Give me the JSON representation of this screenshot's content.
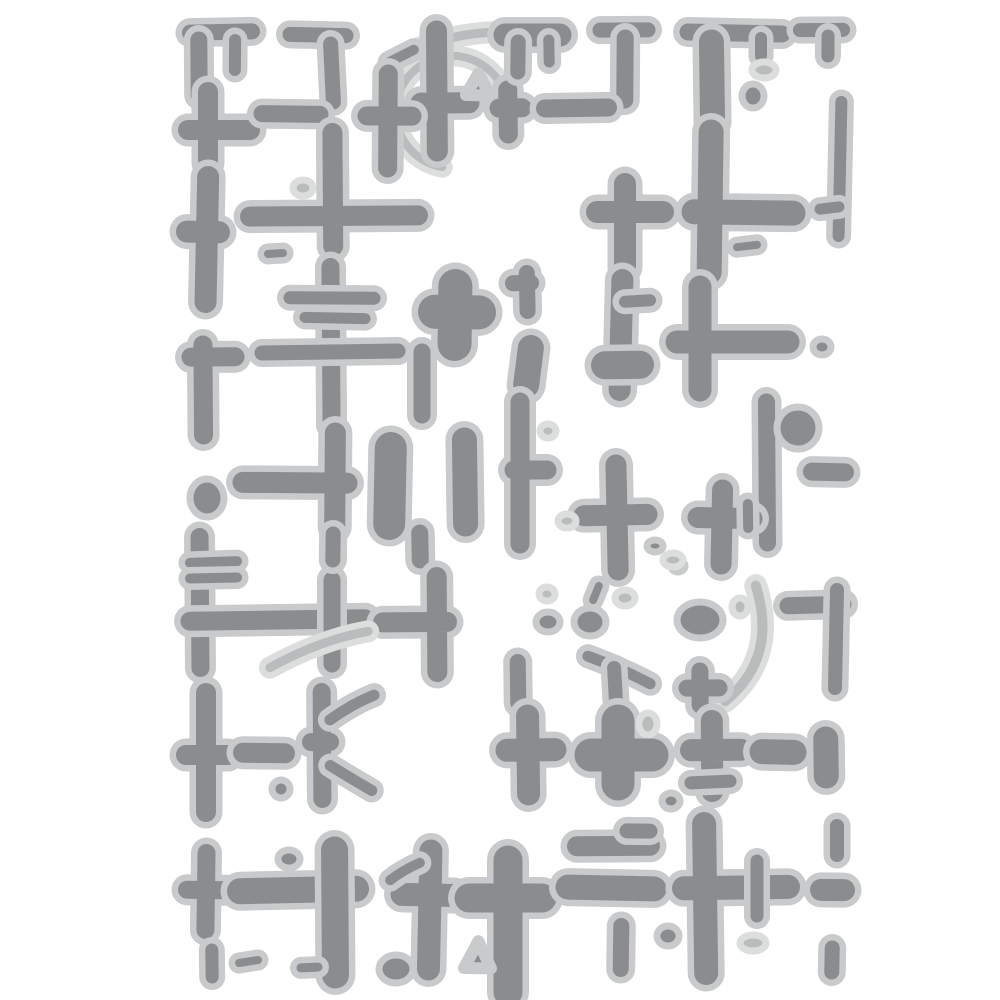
{
  "artwork": {
    "alt": "Abstract distressed pattern of grey crosses, bars, dots, arcs and a crosshair circle on a white background (embossing stencil style)",
    "pattern_name": "distressed-crosses-grid"
  },
  "canvas": {
    "width": 1000,
    "height": 1000,
    "background": "#ffffff"
  },
  "palette": {
    "shape_fill": "#8a8c8e",
    "halo": "#c8cacb",
    "light_fill": "#b9bbbd",
    "light_halo": "#dcdedd",
    "halo_extra_width": 13
  },
  "shapes": [
    {
      "type": "bar",
      "x1": 190,
      "y1": 32,
      "x2": 252,
      "y2": 32,
      "w": 16
    },
    {
      "type": "bar",
      "x1": 199,
      "y1": 40,
      "x2": 199,
      "y2": 95,
      "w": 17
    },
    {
      "type": "bar",
      "x1": 235,
      "y1": 40,
      "x2": 235,
      "y2": 70,
      "w": 12
    },
    {
      "type": "bar",
      "x1": 290,
      "y1": 35,
      "x2": 346,
      "y2": 35,
      "w": 15
    },
    {
      "type": "bar",
      "x1": 331,
      "y1": 44,
      "x2": 333,
      "y2": 102,
      "w": 15
    },
    {
      "type": "arc",
      "x": 452,
      "y": 112,
      "r": 56,
      "a1": 100,
      "a2": 350,
      "w": 8,
      "shade": "light"
    },
    {
      "type": "curve",
      "x1": 400,
      "y1": 57,
      "cx": 458,
      "cy": 28,
      "x2": 517,
      "y2": 32,
      "w": 9,
      "shade": "light"
    },
    {
      "type": "bar",
      "x1": 389,
      "y1": 62,
      "x2": 414,
      "y2": 50,
      "w": 10
    },
    {
      "type": "cross",
      "x": 437,
      "y": 103,
      "up": 72,
      "down": 48,
      "left": 16,
      "right": 32,
      "w": 21
    },
    {
      "type": "cross",
      "x": 388,
      "y": 116,
      "up": 42,
      "down": 52,
      "left": 21,
      "right": 24,
      "w": 19
    },
    {
      "type": "tri",
      "points": [
        [
          466,
          95
        ],
        [
          490,
          95
        ],
        [
          478,
          73
        ]
      ]
    },
    {
      "type": "cross",
      "x": 508,
      "y": 108,
      "up": 18,
      "down": 26,
      "left": 9,
      "right": 14,
      "w": 19
    },
    {
      "type": "bar",
      "x1": 505,
      "y1": 35,
      "x2": 560,
      "y2": 35,
      "w": 23
    },
    {
      "type": "bar",
      "x1": 518,
      "y1": 42,
      "x2": 518,
      "y2": 72,
      "w": 15
    },
    {
      "type": "bar",
      "x1": 549,
      "y1": 40,
      "x2": 549,
      "y2": 62,
      "w": 11
    },
    {
      "type": "bar",
      "x1": 600,
      "y1": 30,
      "x2": 648,
      "y2": 30,
      "w": 15
    },
    {
      "type": "bar",
      "x1": 625,
      "y1": 38,
      "x2": 625,
      "y2": 100,
      "w": 17
    },
    {
      "type": "bar",
      "x1": 688,
      "y1": 33,
      "x2": 782,
      "y2": 33,
      "w": 17
    },
    {
      "type": "bar",
      "x1": 712,
      "y1": 42,
      "x2": 712,
      "y2": 122,
      "w": 25
    },
    {
      "type": "bar",
      "x1": 761,
      "y1": 38,
      "x2": 761,
      "y2": 56,
      "w": 12
    },
    {
      "type": "dot",
      "x": 764,
      "y": 70,
      "rx": 12,
      "ry": 8,
      "shade": "light"
    },
    {
      "type": "dot",
      "x": 753,
      "y": 96,
      "rx": 11,
      "ry": 12
    },
    {
      "type": "bar",
      "x1": 800,
      "y1": 30,
      "x2": 843,
      "y2": 30,
      "w": 14
    },
    {
      "type": "bar",
      "x1": 828,
      "y1": 36,
      "x2": 828,
      "y2": 56,
      "w": 13
    },
    {
      "type": "bar",
      "x1": 840,
      "y1": 102,
      "x2": 840,
      "y2": 236,
      "w": 12
    },
    {
      "type": "bar",
      "x1": 820,
      "y1": 209,
      "x2": 839,
      "y2": 207,
      "w": 11
    },
    {
      "type": "cross",
      "x": 208,
      "y": 130,
      "up": 38,
      "down": 33,
      "left": 20,
      "right": 42,
      "w": 20
    },
    {
      "type": "bar",
      "x1": 262,
      "y1": 114,
      "x2": 320,
      "y2": 114,
      "w": 17
    },
    {
      "type": "dot",
      "x": 303,
      "y": 188,
      "rx": 10,
      "ry": 8,
      "shade": "light"
    },
    {
      "type": "cross",
      "x": 333,
      "y": 216,
      "up": 83,
      "down": 30,
      "left": 83,
      "right": 85,
      "w": 20
    },
    {
      "type": "bar",
      "x1": 268,
      "y1": 254,
      "x2": 283,
      "y2": 253,
      "w": 8
    },
    {
      "type": "cross",
      "x": 207,
      "y": 232,
      "up": 55,
      "down": 70,
      "left": 20,
      "right": 12,
      "w": 22
    },
    {
      "type": "bar",
      "x1": 545,
      "y1": 108,
      "x2": 608,
      "y2": 108,
      "w": 18
    },
    {
      "type": "cross",
      "x": 625,
      "y": 212,
      "up": 28,
      "down": 55,
      "left": 28,
      "right": 38,
      "w": 22
    },
    {
      "type": "cross",
      "x": 710,
      "y": 212,
      "up": 80,
      "down": 60,
      "left": 16,
      "right": 83,
      "w": 25
    },
    {
      "type": "bar",
      "x1": 737,
      "y1": 247,
      "x2": 757,
      "y2": 245,
      "w": 8
    },
    {
      "type": "bar",
      "x1": 331,
      "y1": 267,
      "x2": 331,
      "y2": 425,
      "w": 18
    },
    {
      "type": "bar",
      "x1": 290,
      "y1": 298,
      "x2": 374,
      "y2": 298,
      "w": 13
    },
    {
      "type": "bar",
      "x1": 305,
      "y1": 318,
      "x2": 365,
      "y2": 318,
      "w": 11
    },
    {
      "type": "bar",
      "x1": 262,
      "y1": 352,
      "x2": 398,
      "y2": 352,
      "w": 15
    },
    {
      "type": "bar",
      "x1": 422,
      "y1": 352,
      "x2": 422,
      "y2": 415,
      "w": 17
    },
    {
      "type": "cross",
      "x": 455,
      "y": 312,
      "up": 26,
      "down": 32,
      "left": 20,
      "right": 24,
      "w": 34
    },
    {
      "type": "cross",
      "x": 527,
      "y": 283,
      "up": 10,
      "down": 28,
      "left": 14,
      "right": 4,
      "w": 16
    },
    {
      "type": "bar",
      "x1": 531,
      "y1": 348,
      "x2": 526,
      "y2": 385,
      "w": 26
    },
    {
      "type": "bar",
      "x1": 622,
      "y1": 280,
      "x2": 620,
      "y2": 390,
      "w": 22
    },
    {
      "type": "bar",
      "x1": 625,
      "y1": 302,
      "x2": 650,
      "y2": 300,
      "w": 12
    },
    {
      "type": "bar",
      "x1": 605,
      "y1": 365,
      "x2": 640,
      "y2": 365,
      "w": 28
    },
    {
      "type": "cross",
      "x": 700,
      "y": 342,
      "up": 55,
      "down": 48,
      "left": 23,
      "right": 88,
      "w": 23
    },
    {
      "type": "dot",
      "x": 822,
      "y": 347,
      "rx": 9,
      "ry": 8
    },
    {
      "type": "dot",
      "x": 207,
      "y": 498,
      "rx": 17,
      "ry": 19
    },
    {
      "type": "cross",
      "x": 203,
      "y": 357,
      "up": 12,
      "down": 78,
      "left": 12,
      "right": 32,
      "w": 19
    },
    {
      "type": "cross",
      "x": 335,
      "y": 483,
      "up": 50,
      "down": 44,
      "left": 92,
      "right": 12,
      "w": 21
    },
    {
      "type": "bar",
      "x1": 390,
      "y1": 448,
      "x2": 390,
      "y2": 524,
      "w": 32
    },
    {
      "type": "bar",
      "x1": 465,
      "y1": 440,
      "x2": 465,
      "y2": 524,
      "w": 25
    },
    {
      "type": "cross",
      "x": 520,
      "y": 470,
      "up": 68,
      "down": 74,
      "left": 6,
      "right": 27,
      "w": 19
    },
    {
      "type": "dot",
      "x": 548,
      "y": 431,
      "rx": 8,
      "ry": 7,
      "shade": "light"
    },
    {
      "type": "cross",
      "x": 617,
      "y": 515,
      "up": 50,
      "down": 55,
      "left": 33,
      "right": 30,
      "w": 21
    },
    {
      "type": "bar",
      "x1": 767,
      "y1": 402,
      "x2": 767,
      "y2": 543,
      "w": 17
    },
    {
      "type": "dot",
      "x": 798,
      "y": 428,
      "rx": 21,
      "ry": 21
    },
    {
      "type": "bar",
      "x1": 812,
      "y1": 472,
      "x2": 845,
      "y2": 472,
      "w": 18
    },
    {
      "type": "dot",
      "x": 567,
      "y": 521,
      "rx": 9,
      "ry": 7,
      "shade": "light"
    },
    {
      "type": "dot",
      "x": 655,
      "y": 546,
      "rx": 8,
      "ry": 6
    },
    {
      "type": "dot",
      "x": 678,
      "y": 566,
      "rx": 7,
      "ry": 6
    },
    {
      "type": "dot",
      "x": 625,
      "y": 598,
      "rx": 10,
      "ry": 8,
      "shade": "light"
    },
    {
      "type": "bar",
      "x1": 200,
      "y1": 537,
      "x2": 200,
      "y2": 668,
      "w": 18
    },
    {
      "type": "bar",
      "x1": 190,
      "y1": 563,
      "x2": 237,
      "y2": 561,
      "w": 10
    },
    {
      "type": "bar",
      "x1": 190,
      "y1": 579,
      "x2": 237,
      "y2": 577,
      "w": 10
    },
    {
      "type": "bar",
      "x1": 190,
      "y1": 620,
      "x2": 365,
      "y2": 620,
      "w": 19
    },
    {
      "type": "bar",
      "x1": 332,
      "y1": 580,
      "x2": 332,
      "y2": 664,
      "w": 17
    },
    {
      "type": "bar",
      "x1": 333,
      "y1": 534,
      "x2": 333,
      "y2": 560,
      "w": 15
    },
    {
      "type": "bar",
      "x1": 420,
      "y1": 533,
      "x2": 420,
      "y2": 560,
      "w": 17
    },
    {
      "type": "cross",
      "x": 437,
      "y": 622,
      "up": 45,
      "down": 50,
      "left": 54,
      "right": 10,
      "w": 20
    },
    {
      "type": "curve",
      "x1": 270,
      "y1": 668,
      "cx": 320,
      "cy": 640,
      "x2": 368,
      "y2": 631,
      "w": 9,
      "shade": "light"
    },
    {
      "type": "cross",
      "x": 722,
      "y": 518,
      "up": 28,
      "down": 46,
      "left": 24,
      "right": 30,
      "w": 21
    },
    {
      "type": "bar",
      "x1": 748,
      "y1": 504,
      "x2": 748,
      "y2": 528,
      "w": 10
    },
    {
      "type": "dot",
      "x": 700,
      "y": 620,
      "rx": 23,
      "ry": 18
    },
    {
      "type": "dot",
      "x": 740,
      "y": 607,
      "rx": 8,
      "ry": 9,
      "shade": "light"
    },
    {
      "type": "curve",
      "x1": 757,
      "y1": 586,
      "cx": 778,
      "cy": 658,
      "x2": 724,
      "y2": 701,
      "w": 10,
      "shade": "light"
    },
    {
      "type": "cross",
      "x": 700,
      "y": 688,
      "up": 17,
      "down": 17,
      "left": 13,
      "right": 19,
      "w": 17
    },
    {
      "type": "bar",
      "x1": 788,
      "y1": 606,
      "x2": 843,
      "y2": 604,
      "w": 17
    },
    {
      "type": "bar",
      "x1": 836,
      "y1": 590,
      "x2": 836,
      "y2": 688,
      "w": 14
    },
    {
      "type": "dot",
      "x": 673,
      "y": 560,
      "rx": 10,
      "ry": 7,
      "shade": "light"
    },
    {
      "type": "dot",
      "x": 548,
      "y": 622,
      "rx": 12,
      "ry": 10
    },
    {
      "type": "dot",
      "x": 590,
      "y": 622,
      "rx": 16,
      "ry": 14
    },
    {
      "type": "bar",
      "x1": 593,
      "y1": 600,
      "x2": 599,
      "y2": 586,
      "w": 8
    },
    {
      "type": "curve",
      "x1": 588,
      "y1": 656,
      "cx": 620,
      "cy": 668,
      "x2": 650,
      "y2": 684,
      "w": 11
    },
    {
      "type": "bar",
      "x1": 614,
      "y1": 668,
      "x2": 616,
      "y2": 700,
      "w": 14
    },
    {
      "type": "dot",
      "x": 547,
      "y": 594,
      "rx": 8,
      "ry": 7,
      "shade": "light"
    },
    {
      "type": "bar",
      "x1": 518,
      "y1": 662,
      "x2": 518,
      "y2": 703,
      "w": 16
    },
    {
      "type": "cross",
      "x": 206,
      "y": 755,
      "up": 62,
      "down": 57,
      "left": 20,
      "right": 22,
      "w": 20
    },
    {
      "type": "bar",
      "x1": 243,
      "y1": 753,
      "x2": 285,
      "y2": 753,
      "w": 20
    },
    {
      "type": "dot",
      "x": 281,
      "y": 789,
      "rx": 9,
      "ry": 9
    },
    {
      "type": "cross",
      "x": 322,
      "y": 742,
      "up": 50,
      "down": 57,
      "left": 11,
      "right": 8,
      "w": 18
    },
    {
      "type": "curve",
      "x1": 330,
      "y1": 720,
      "cx": 352,
      "cy": 704,
      "x2": 374,
      "y2": 695,
      "w": 11
    },
    {
      "type": "curve",
      "x1": 330,
      "y1": 766,
      "cx": 352,
      "cy": 779,
      "x2": 372,
      "y2": 790,
      "w": 11
    },
    {
      "type": "cross",
      "x": 528,
      "y": 750,
      "up": 34,
      "down": 44,
      "left": 21,
      "right": 27,
      "w": 23
    },
    {
      "type": "cross",
      "x": 618,
      "y": 755,
      "up": 34,
      "down": 29,
      "left": 27,
      "right": 34,
      "w": 33
    },
    {
      "type": "dot",
      "x": 648,
      "y": 724,
      "rx": 9,
      "ry": 11,
      "shade": "light"
    },
    {
      "type": "dot",
      "x": 671,
      "y": 801,
      "rx": 9,
      "ry": 8
    },
    {
      "type": "cross",
      "x": 712,
      "y": 750,
      "up": 29,
      "down": 41,
      "left": 21,
      "right": 29,
      "w": 22
    },
    {
      "type": "bar",
      "x1": 691,
      "y1": 783,
      "x2": 730,
      "y2": 781,
      "w": 13
    },
    {
      "type": "bar",
      "x1": 762,
      "y1": 752,
      "x2": 794,
      "y2": 752,
      "w": 25
    },
    {
      "type": "bar",
      "x1": 826,
      "y1": 739,
      "x2": 826,
      "y2": 776,
      "w": 25
    },
    {
      "type": "bar",
      "x1": 837,
      "y1": 826,
      "x2": 837,
      "y2": 855,
      "w": 14
    },
    {
      "type": "cross",
      "x": 206,
      "y": 890,
      "up": 37,
      "down": 40,
      "left": 19,
      "right": 22,
      "w": 18
    },
    {
      "type": "bar",
      "x1": 240,
      "y1": 890,
      "x2": 356,
      "y2": 890,
      "w": 26
    },
    {
      "type": "bar",
      "x1": 335,
      "y1": 850,
      "x2": 335,
      "y2": 975,
      "w": 27
    },
    {
      "type": "dot",
      "x": 289,
      "y": 859,
      "rx": 11,
      "ry": 9
    },
    {
      "type": "cross",
      "x": 430,
      "y": 895,
      "up": 44,
      "down": 74,
      "left": 28,
      "right": 24,
      "w": 23
    },
    {
      "type": "curve",
      "x1": 390,
      "y1": 880,
      "cx": 403,
      "cy": 870,
      "x2": 420,
      "y2": 863,
      "w": 10
    },
    {
      "type": "cross",
      "x": 508,
      "y": 898,
      "up": 38,
      "down": 94,
      "left": 39,
      "right": 34,
      "w": 29
    },
    {
      "type": "tri",
      "points": [
        [
          464,
          968
        ],
        [
          491,
          968
        ],
        [
          478,
          941
        ]
      ]
    },
    {
      "type": "dot",
      "x": 396,
      "y": 969,
      "rx": 17,
      "ry": 14
    },
    {
      "type": "bar",
      "x1": 577,
      "y1": 846,
      "x2": 650,
      "y2": 846,
      "w": 20
    },
    {
      "type": "bar",
      "x1": 627,
      "y1": 831,
      "x2": 650,
      "y2": 831,
      "w": 15
    },
    {
      "type": "bar",
      "x1": 568,
      "y1": 888,
      "x2": 654,
      "y2": 888,
      "w": 25
    },
    {
      "type": "cross",
      "x": 705,
      "y": 888,
      "up": 64,
      "down": 85,
      "left": 21,
      "right": 83,
      "w": 24
    },
    {
      "type": "bar",
      "x1": 757,
      "y1": 861,
      "x2": 757,
      "y2": 916,
      "w": 13
    },
    {
      "type": "bar",
      "x1": 621,
      "y1": 926,
      "x2": 621,
      "y2": 969,
      "w": 16
    },
    {
      "type": "dot",
      "x": 668,
      "y": 936,
      "rx": 11,
      "ry": 10
    },
    {
      "type": "dot",
      "x": 753,
      "y": 943,
      "rx": 13,
      "ry": 8,
      "shade": "light"
    },
    {
      "type": "bar",
      "x1": 821,
      "y1": 890,
      "x2": 844,
      "y2": 890,
      "w": 22
    },
    {
      "type": "bar",
      "x1": 832,
      "y1": 948,
      "x2": 832,
      "y2": 972,
      "w": 15
    },
    {
      "type": "bar",
      "x1": 212,
      "y1": 950,
      "x2": 212,
      "y2": 977,
      "w": 13
    },
    {
      "type": "bar",
      "x1": 239,
      "y1": 963,
      "x2": 258,
      "y2": 960,
      "w": 8
    },
    {
      "type": "bar",
      "x1": 301,
      "y1": 968,
      "x2": 318,
      "y2": 967,
      "w": 9
    }
  ]
}
